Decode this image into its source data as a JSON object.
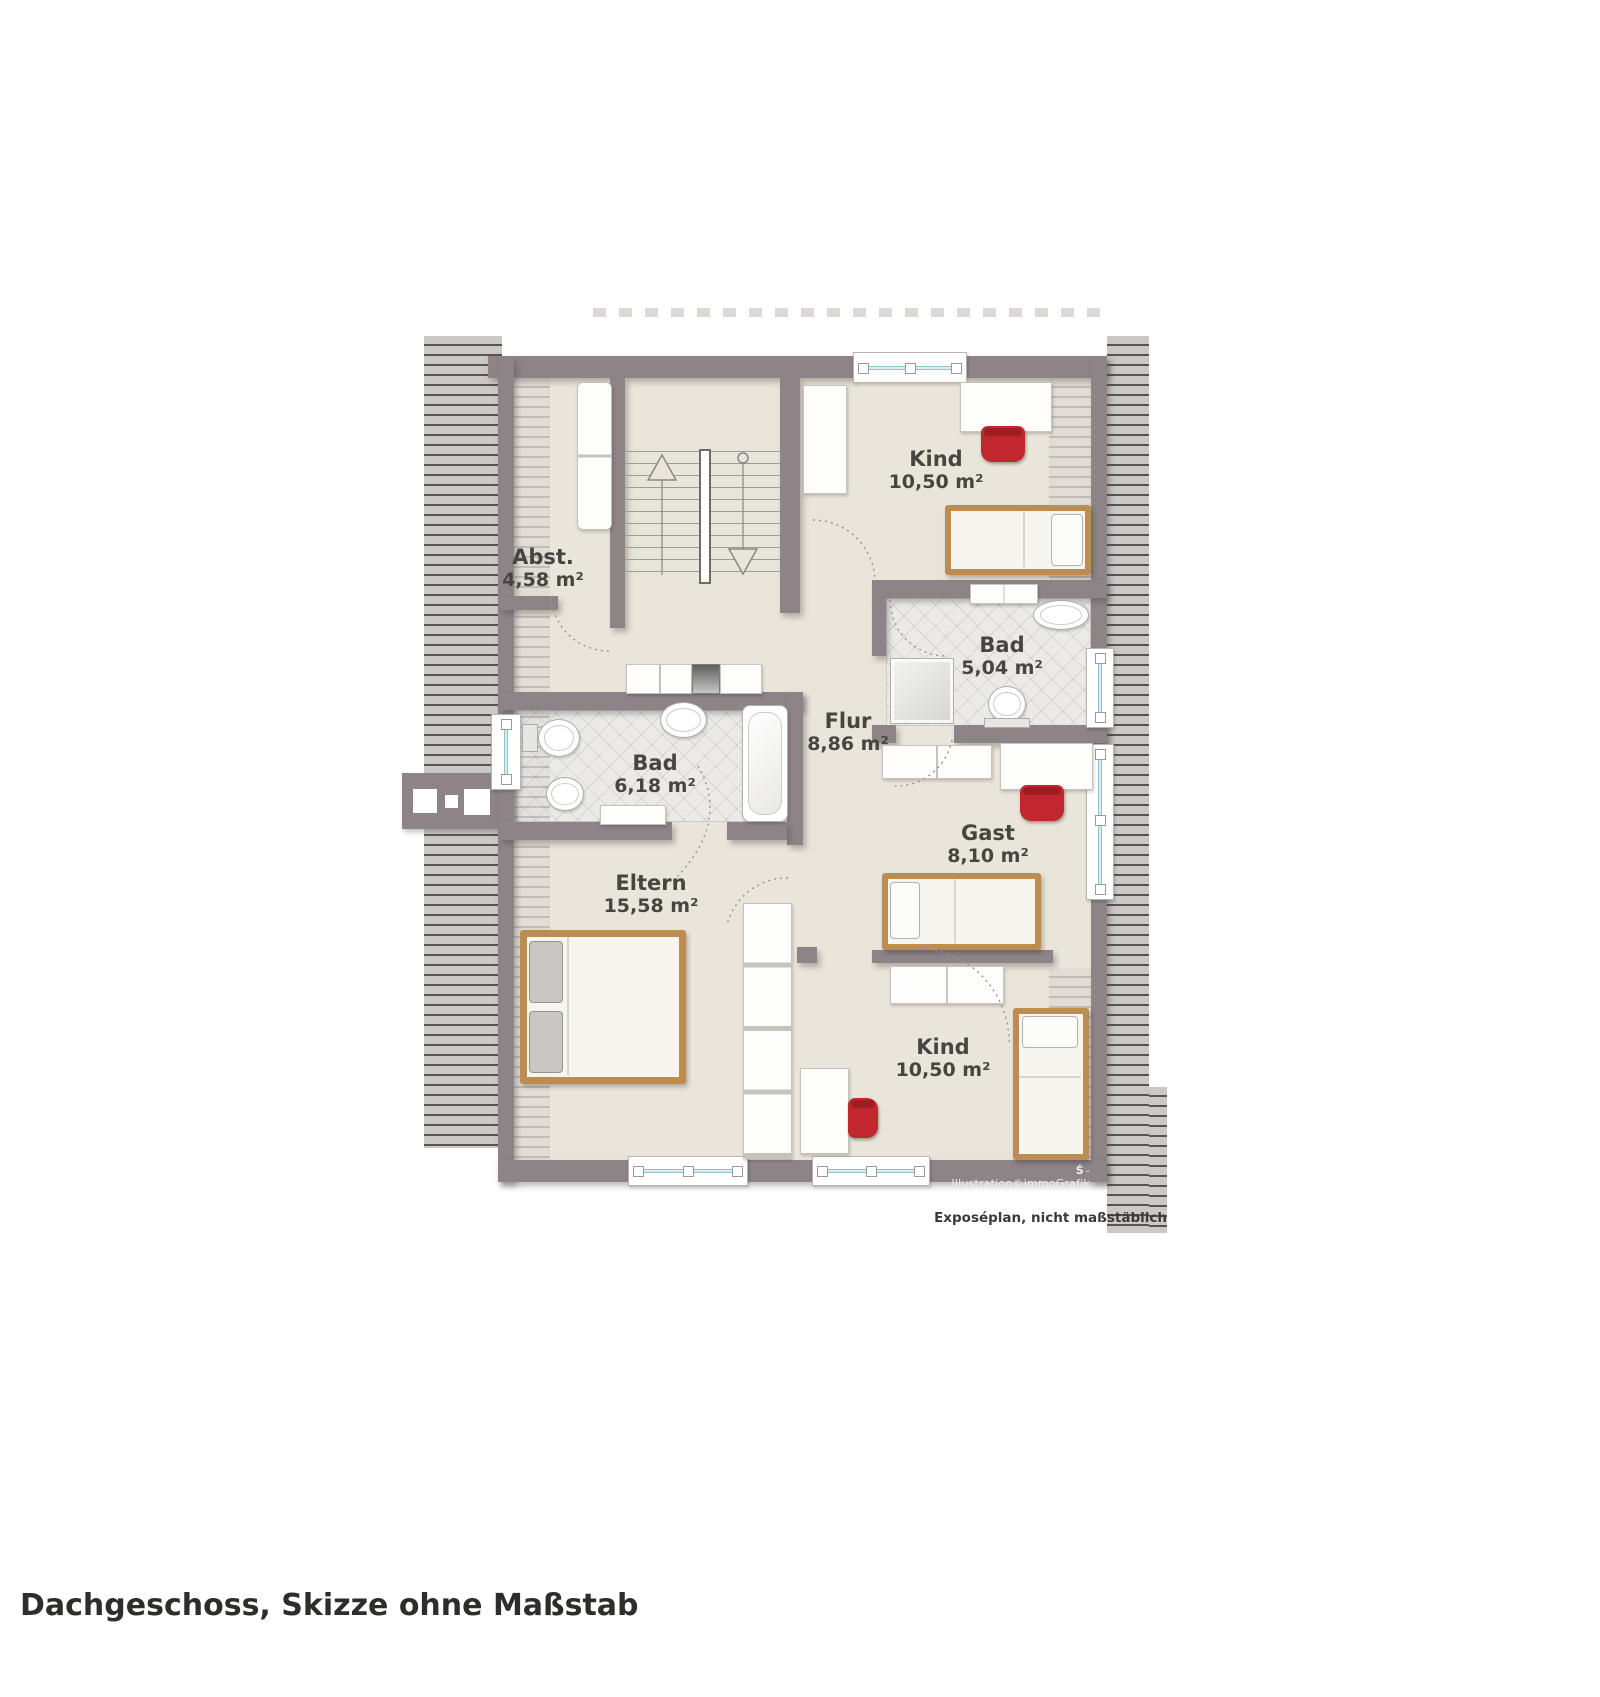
{
  "page": {
    "caption": "Dachgeschoss, Skizze ohne Maßstab",
    "disclaimer": "Exposéplan, nicht maßstäblich",
    "credit": "Illustration©immoGrafik",
    "credit_prefix": "-"
  },
  "rooms": {
    "abst": {
      "name": "Abst.",
      "area": "4,58 m²"
    },
    "kind_oben": {
      "name": "Kind",
      "area": "10,50 m²"
    },
    "bad_klein": {
      "name": "Bad",
      "area": "5,04 m²"
    },
    "flur": {
      "name": "Flur",
      "area": "8,86 m²"
    },
    "bad_gross": {
      "name": "Bad",
      "area": "6,18 m²"
    },
    "gast": {
      "name": "Gast",
      "area": "8,10 m²"
    },
    "eltern": {
      "name": "Eltern",
      "area": "15,58 m²"
    },
    "kind_unten": {
      "name": "Kind",
      "area": "10,50 m²"
    }
  },
  "icons": {
    "sparkasse_logo": "Ś",
    "stairs_up_arrow": "△",
    "stairs_down_arrow": "▽"
  },
  "colors": {
    "wall": "#8d8488",
    "floor": "#eae5da",
    "tile": "#eceae6",
    "roof_hatch_light": "#cbc8c7",
    "roof_hatch_dark": "#585451",
    "wood": "#bd8c51",
    "chair_red": "#c1272d",
    "window_blue": "#d9edf2",
    "label_text": "#474540"
  }
}
